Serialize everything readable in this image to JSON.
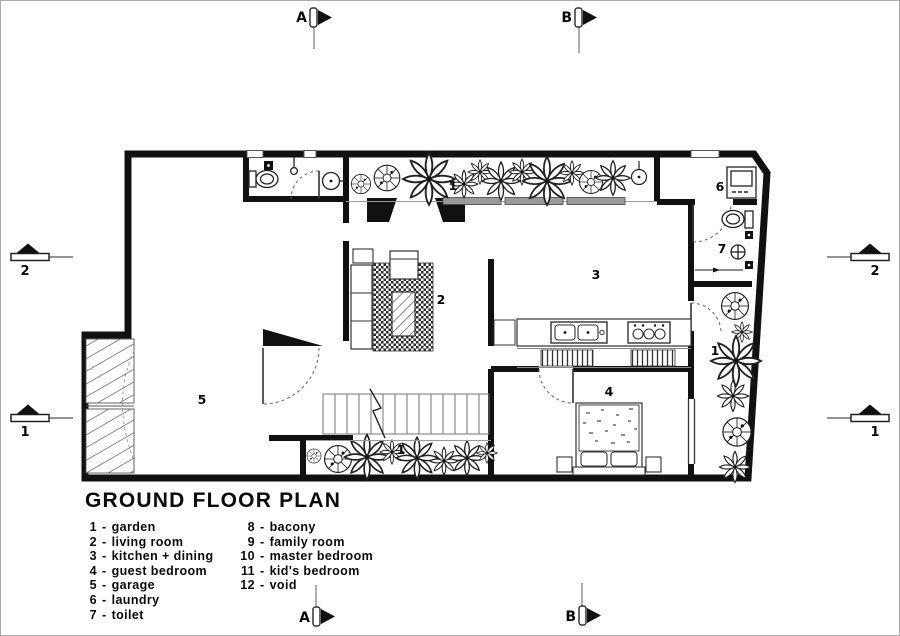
{
  "legend": {
    "title": "GROUND FLOOR PLAN",
    "sep": "-",
    "items": [
      {
        "num": "1",
        "label": "garden"
      },
      {
        "num": "2",
        "label": "living room"
      },
      {
        "num": "3",
        "label": "kitchen + dining"
      },
      {
        "num": "4",
        "label": "guest bedroom"
      },
      {
        "num": "5",
        "label": "garage"
      },
      {
        "num": "6",
        "label": "laundry"
      },
      {
        "num": "7",
        "label": "toilet"
      },
      {
        "num": "8",
        "label": "bacony"
      },
      {
        "num": "9",
        "label": "family room"
      },
      {
        "num": "10",
        "label": "master bedroom"
      },
      {
        "num": "11",
        "label": "kid's bedroom"
      },
      {
        "num": "12",
        "label": "void"
      }
    ]
  },
  "markers": {
    "top": [
      "A",
      "B"
    ],
    "bottom": [
      "A",
      "B"
    ],
    "left": [
      "2",
      "1"
    ],
    "right": [
      "2",
      "1"
    ]
  },
  "rooms": [
    {
      "name": "garden-top",
      "num": "1"
    },
    {
      "name": "laundry",
      "num": "6"
    },
    {
      "name": "toilet",
      "num": "7"
    },
    {
      "name": "kitchen-dining",
      "num": "3"
    },
    {
      "name": "living-room",
      "num": "2"
    },
    {
      "name": "garden-right",
      "num": "1"
    },
    {
      "name": "garage",
      "num": "5"
    },
    {
      "name": "guest-bedroom",
      "num": "4"
    },
    {
      "name": "garden-bottom",
      "num": "1"
    }
  ],
  "colors": {
    "ink": "#0a0a0a",
    "wall": "#111111",
    "line_gray": "#808080",
    "paper": "#ffffff",
    "sheet_border": "#ababab"
  }
}
